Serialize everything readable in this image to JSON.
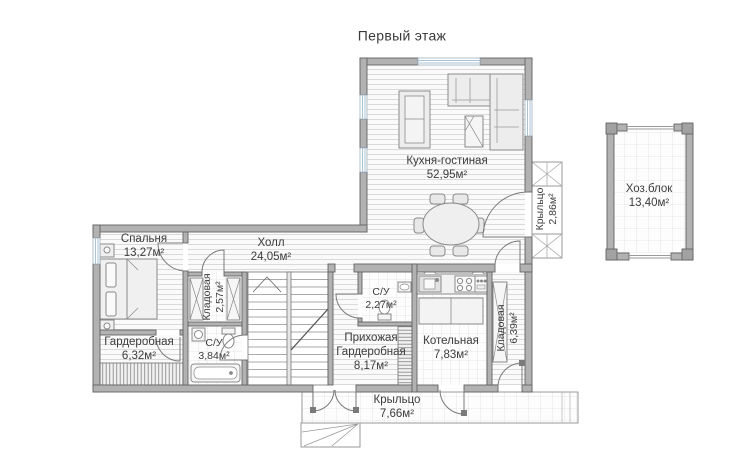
{
  "title": "Первый этаж",
  "rooms": {
    "kitchen_living": {
      "name": "Кухня-гостиная",
      "area": "52,95м²"
    },
    "bedroom": {
      "name": "Спальня",
      "area": "13,27м²"
    },
    "hall": {
      "name": "Холл",
      "area": "24,05м²"
    },
    "dressing": {
      "name": "Гардеробная",
      "area": "6,32м²"
    },
    "pantry_hall": {
      "name": "Кладовая",
      "area": "2,57м²"
    },
    "bathroom_main": {
      "name": "С/У",
      "area": "3,84м²"
    },
    "bathroom_small": {
      "name": "С/У",
      "area": "2,27м²"
    },
    "entry": {
      "line1": "Прихожая",
      "line2": "Гардеробная",
      "area": "8,17м²"
    },
    "boiler_room": {
      "name": "Котельная",
      "area": "7,83м²"
    },
    "pantry_boiler": {
      "name": "Кладовая",
      "area": "6,39м²"
    },
    "porch_side": {
      "name": "Крыльцо",
      "area": "2,86м²"
    },
    "porch_main": {
      "name": "Крыльцо",
      "area": "7,66м²"
    },
    "utility_block": {
      "name": "Хоз.блок",
      "area": "13,40м²"
    }
  },
  "colors": {
    "wall": "#b2b2b2",
    "wall_edge": "#636363",
    "floor_line": "#dadada",
    "tile_line": "#e0e0e0",
    "window_glass": "#aac3d4",
    "text": "#3c3c3c"
  }
}
